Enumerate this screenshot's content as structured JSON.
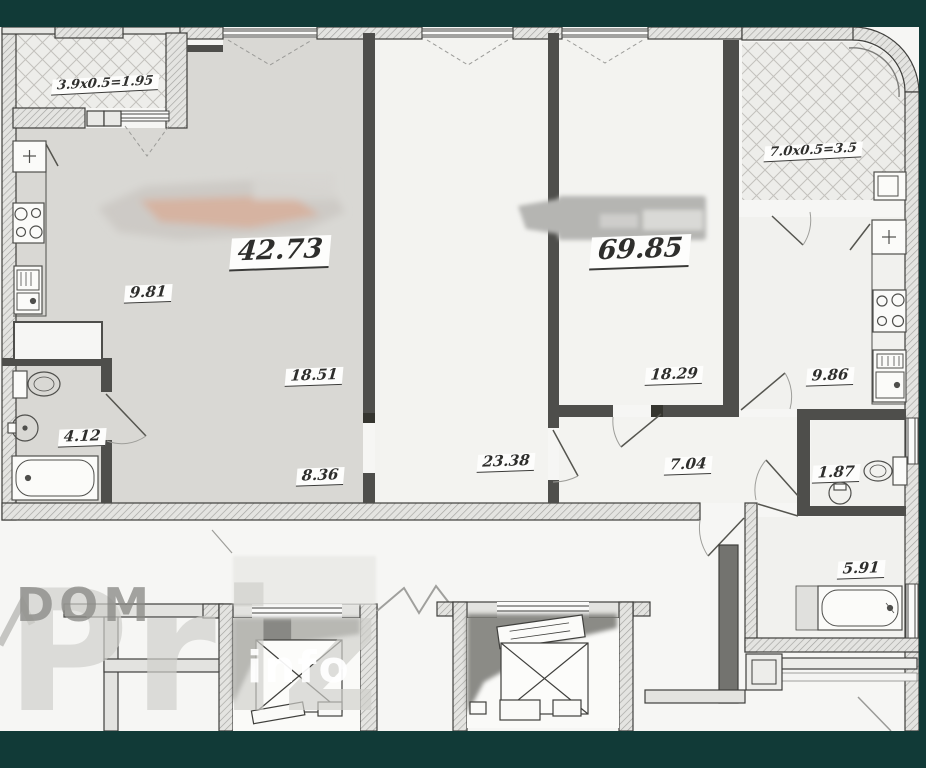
{
  "frame": {
    "color": "#113a37"
  },
  "watermarks": {
    "dom": "DOM",
    "priz": "Priz",
    "info": "info"
  },
  "rooms": [
    {
      "id": "balcony-left",
      "label": "3.9x0.5=1.95"
    },
    {
      "id": "apartment-left-total",
      "label": "42.73"
    },
    {
      "id": "kitchen-left",
      "label": "9.81"
    },
    {
      "id": "living-left",
      "label": "18.51"
    },
    {
      "id": "hall-left",
      "label": "8.36"
    },
    {
      "id": "bathroom-left",
      "label": "4.12"
    },
    {
      "id": "room-middle",
      "label": "23.38"
    },
    {
      "id": "apartment-right-total",
      "label": "69.85"
    },
    {
      "id": "room-right",
      "label": "18.29"
    },
    {
      "id": "hall-right",
      "label": "7.04"
    },
    {
      "id": "balcony-right",
      "label": "7.0x0.5=3.5"
    },
    {
      "id": "kitchen-right",
      "label": "9.86"
    },
    {
      "id": "wc-right",
      "label": "1.87"
    },
    {
      "id": "bathroom-right",
      "label": "5.91"
    }
  ]
}
